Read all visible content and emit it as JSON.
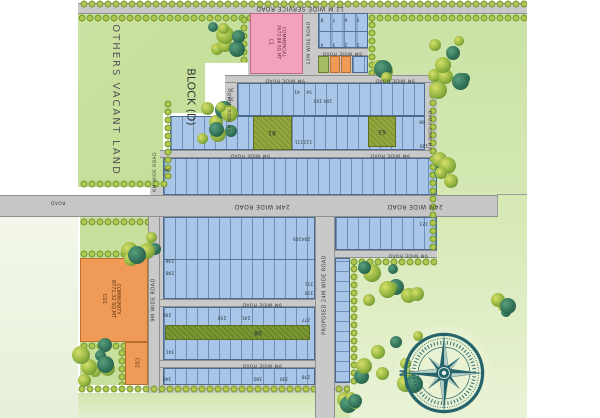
{
  "roads": {
    "service_12m": "12 M WIDE SERVICE ROAD",
    "r12m": "12M WIDE ROAD",
    "r9m": "9M WIDE ROAD",
    "r6m": "6M WIDE ROAD",
    "r24m": "24M WIDE ROAD",
    "proposed_24m": "PROPOSED 24M WIDE ROAD",
    "stub": "ROAD"
  },
  "zones": {
    "vacant": "OTHERS VACANT LAND",
    "block": "BLOCK (D)",
    "commercial": {
      "name": "COMMERCIAL",
      "area": "3672.88 SQ.MT",
      "code": "C1"
    },
    "community": {
      "name": "COMMUNITY",
      "area": "8771.32 SQ.MT",
      "code": "C01"
    },
    "community2_code": "C02"
  },
  "compass": {
    "north_label": "N"
  },
  "colors": {
    "plot_fill": "#a9c6e8",
    "commercial_pink": "#f2a3bb",
    "community_orange": "#f09a57",
    "park_olive": "#93a93f",
    "road_gray": "#c9c9c9",
    "field_green": "#cde4a8",
    "compass_teal": "#26646d"
  },
  "plot_numbers": [
    {
      "t": "8",
      "x": 322,
      "y": 18
    },
    {
      "t": "7",
      "x": 334,
      "y": 18
    },
    {
      "t": "6",
      "x": 346,
      "y": 18
    },
    {
      "t": "5",
      "x": 358,
      "y": 18
    },
    {
      "t": "4",
      "x": 322,
      "y": 43
    },
    {
      "t": "3",
      "x": 334,
      "y": 43
    },
    {
      "t": "2",
      "x": 346,
      "y": 43
    },
    {
      "t": "1",
      "x": 358,
      "y": 43
    },
    {
      "t": "30",
      "x": 231,
      "y": 88
    },
    {
      "t": "32",
      "x": 231,
      "y": 97
    },
    {
      "t": "41",
      "x": 297,
      "y": 90
    },
    {
      "t": "54",
      "x": 309,
      "y": 90
    },
    {
      "t": "103",
      "x": 318,
      "y": 99
    },
    {
      "t": "104",
      "x": 328,
      "y": 99
    },
    {
      "t": "111",
      "x": 299,
      "y": 140
    },
    {
      "t": "112",
      "x": 308,
      "y": 140
    },
    {
      "t": "81",
      "x": 272,
      "y": 132,
      "s": 6
    },
    {
      "t": "63",
      "x": 382,
      "y": 131,
      "s": 6
    },
    {
      "t": "66",
      "x": 422,
      "y": 120
    },
    {
      "t": "120",
      "x": 424,
      "y": 144
    },
    {
      "t": "96",
      "x": 167,
      "y": 168
    },
    {
      "t": "123",
      "x": 424,
      "y": 222
    },
    {
      "t": "205",
      "x": 297,
      "y": 237
    },
    {
      "t": "204",
      "x": 306,
      "y": 237
    },
    {
      "t": "236",
      "x": 170,
      "y": 259
    },
    {
      "t": "298",
      "x": 170,
      "y": 271
    },
    {
      "t": "311",
      "x": 309,
      "y": 282
    },
    {
      "t": "310",
      "x": 309,
      "y": 291
    },
    {
      "t": "290",
      "x": 167,
      "y": 313
    },
    {
      "t": "250",
      "x": 222,
      "y": 316
    },
    {
      "t": "241",
      "x": 246,
      "y": 316
    },
    {
      "t": "98",
      "x": 258,
      "y": 332,
      "s": 6
    },
    {
      "t": "341",
      "x": 170,
      "y": 350
    },
    {
      "t": "277",
      "x": 306,
      "y": 318
    },
    {
      "t": "340",
      "x": 167,
      "y": 377
    },
    {
      "t": "330",
      "x": 284,
      "y": 377
    },
    {
      "t": "300",
      "x": 258,
      "y": 377
    },
    {
      "t": "278",
      "x": 306,
      "y": 375
    }
  ]
}
